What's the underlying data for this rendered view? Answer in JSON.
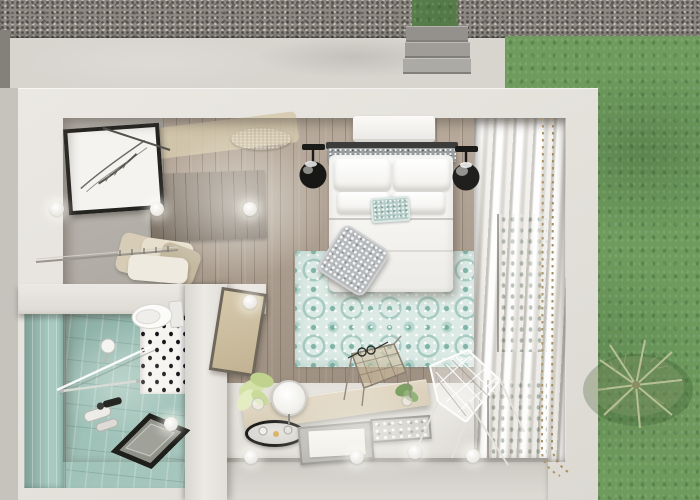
{
  "scene": {
    "type": "3d-isometric-floorplan-render",
    "description": "Top-down 3D render of a studio guest room: bedroom with double bed and teal rug, walk-in closet with artwork, teal-tiled bathroom with walk-in shower, vanity desk with wire chairs; outside are a gravel strip, concrete walkway with steps and a grass lawn",
    "palette": {
      "gravel": "#8d8982",
      "concrete": "#aeacaa",
      "grass": "#6f9b5e",
      "wall-white": "#ebe8e3",
      "wood-floor": "#b0a191",
      "closet-floor": "#b6b2ab",
      "rug-base": "#dceae5",
      "rug-accent": "#7fb5a8",
      "bath-tile": "#9cc0b6",
      "bath-wall": "#a6cac0",
      "curtain": "#e9e7e2",
      "desk": "#d6cbb4",
      "window-green": "#66904f",
      "gold-mat": "#a4975c",
      "bottom-wall": "#ccc9c3",
      "fabric-tan": "#d7cdb6",
      "frame-black": "#232320"
    }
  },
  "objects": {
    "lawn": "Grass lawn",
    "gravel": "Gravel strip",
    "walkway": "Concrete walkway",
    "steps": "Concrete steps",
    "room": "Room outer walls",
    "closet": "Walk-in closet floor",
    "artwork": "Framed botanical sketch",
    "rail": "Closet rail with hangers",
    "clothes": "Hanging clothes",
    "wood_floor": "Wood plank floor",
    "entry_patch": "Entry floor area",
    "gold_mat": "Round jute mat",
    "wood_panel": "Weathered wood panel",
    "rug": "Teal patterned area rug",
    "bed": "Double bed with white bedding",
    "headboard": "Upholstered headboard",
    "pillow": "Pillow",
    "teal_cushion": "Teal accent cushion",
    "throw_pillow": "Patterned throw pillow",
    "ac_unit": "Air-conditioning unit",
    "lamp_left": "Black globe pendant lamp (left)",
    "lamp_right": "Black globe pendant lamp (right)",
    "curtains": "Sheer curtains",
    "window": "Window to the garden",
    "bead_track": "Beaded curtain track",
    "bathroom_floor": "Teal tiled bathroom floor",
    "bathroom_wall": "Teal tiled bathroom wall",
    "polka_wall": "Dotted accent wall",
    "toilet": "Toilet",
    "shower_glass": "Glass shower screen",
    "shower_head": "Shower head",
    "shower_mixer": "Shower mixer tap",
    "towel_bar": "Towel bar",
    "drain": "Walk-in shower tray",
    "wall_mid": "Partition wall",
    "divider": "Partition wall between bathroom and bedroom",
    "lean_mirror": "Leaning framed mirror",
    "desk": "Vanity desk",
    "mirror_round": "Round vanity mirror",
    "tray_oval": "Black oval vanity tray",
    "tray_board": "Tray with white board",
    "tray_small": "Decorative tray",
    "plant_left": "Potted plant by desk",
    "plant_desk": "Small plant on desk",
    "desk_chair": "Wire desk chair",
    "cocoon_chair": "Wire cocoon chair",
    "glasses": "Reading glasses on rug",
    "palm": "Garden fern plant",
    "light": "Ceiling spot light"
  },
  "lights": [
    [
      57,
      209
    ],
    [
      157,
      209
    ],
    [
      250,
      209
    ],
    [
      250,
      302
    ],
    [
      171,
      424
    ],
    [
      251,
      457
    ],
    [
      357,
      457
    ],
    [
      415,
      452
    ],
    [
      473,
      456
    ]
  ]
}
